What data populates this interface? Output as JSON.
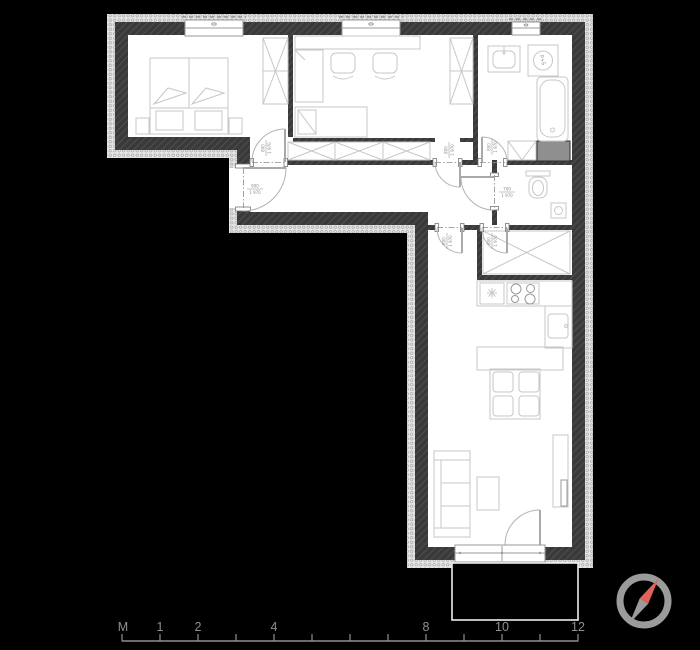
{
  "plan": {
    "type": "apartment-floor-plan",
    "labels": {
      "washer": "P+S"
    },
    "doors": {
      "entry": {
        "width": "900",
        "height": "1 970"
      },
      "bedroom": {
        "width": "800",
        "height": "1 970"
      },
      "office": {
        "width": "800",
        "height": "1 970"
      },
      "bathroom": {
        "width": "800",
        "height": "1 970"
      },
      "wc": {
        "width": "700",
        "height": "1 970"
      },
      "living": {
        "width": "800",
        "height": "1 970"
      },
      "storage": {
        "width": "800",
        "height": "1 970"
      }
    }
  },
  "scalebar": {
    "unit": "M",
    "tick_labels": [
      "1",
      "2",
      "4",
      "8",
      "10",
      "12"
    ]
  },
  "colors": {
    "background": "#000000",
    "floor": "#ffffff",
    "wall": "#3a3a3a",
    "wall_hatch": "#5c5c5c",
    "insulation": "#e4e4e4",
    "furniture": "#c7c7c7",
    "shaft": "#8f8f8f",
    "label": "#8a8a8a",
    "scale": "#8f8f8f",
    "compass_ring": "#9b9b9b",
    "compass_north": "#e0635a",
    "compass_south": "#9b9b9b"
  }
}
